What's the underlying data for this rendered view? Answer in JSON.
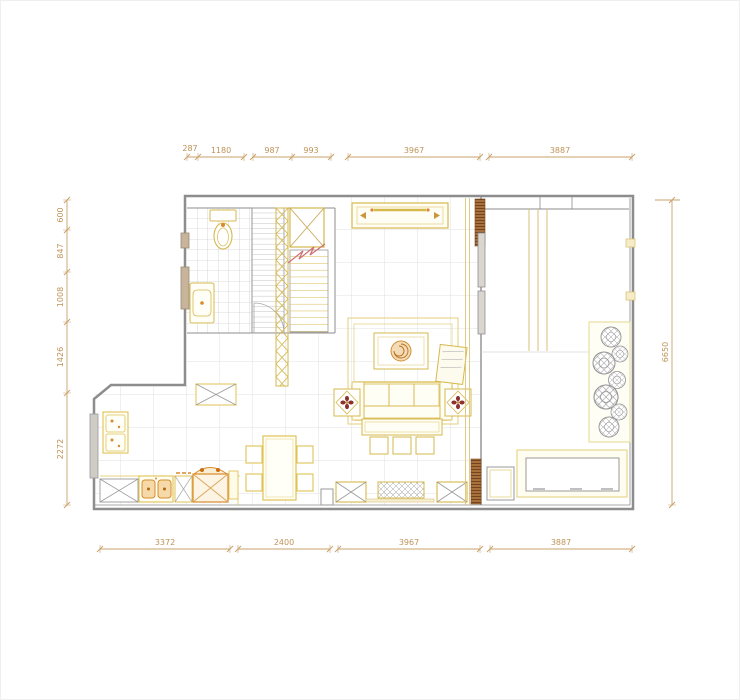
{
  "title": "apartment-floor-plan",
  "colors": {
    "dimension_line": "#c9a26a",
    "dimension_text": "#bd9357",
    "wall": "#8d8d8d",
    "furniture_gold": "#d6b84c",
    "furniture_light_gold": "#e6d88e",
    "accent_orange": "#d98a2b",
    "wall_hatch_brown": "#a8703a",
    "break_line_red": "#cf6f6f",
    "floor_grid": "#d6d6d6",
    "window_fill": "#c7b49b"
  },
  "dimensions": {
    "top": {
      "labels": [
        "287",
        "1180",
        "987",
        "993",
        "3967",
        "3887"
      ]
    },
    "bottom": {
      "labels": [
        "3372",
        "2400",
        "3967",
        "3887"
      ]
    },
    "left": {
      "labels": [
        "600",
        "847",
        "1008",
        "1426",
        "2272"
      ]
    },
    "right": {
      "labels": [
        "6650"
      ]
    }
  }
}
